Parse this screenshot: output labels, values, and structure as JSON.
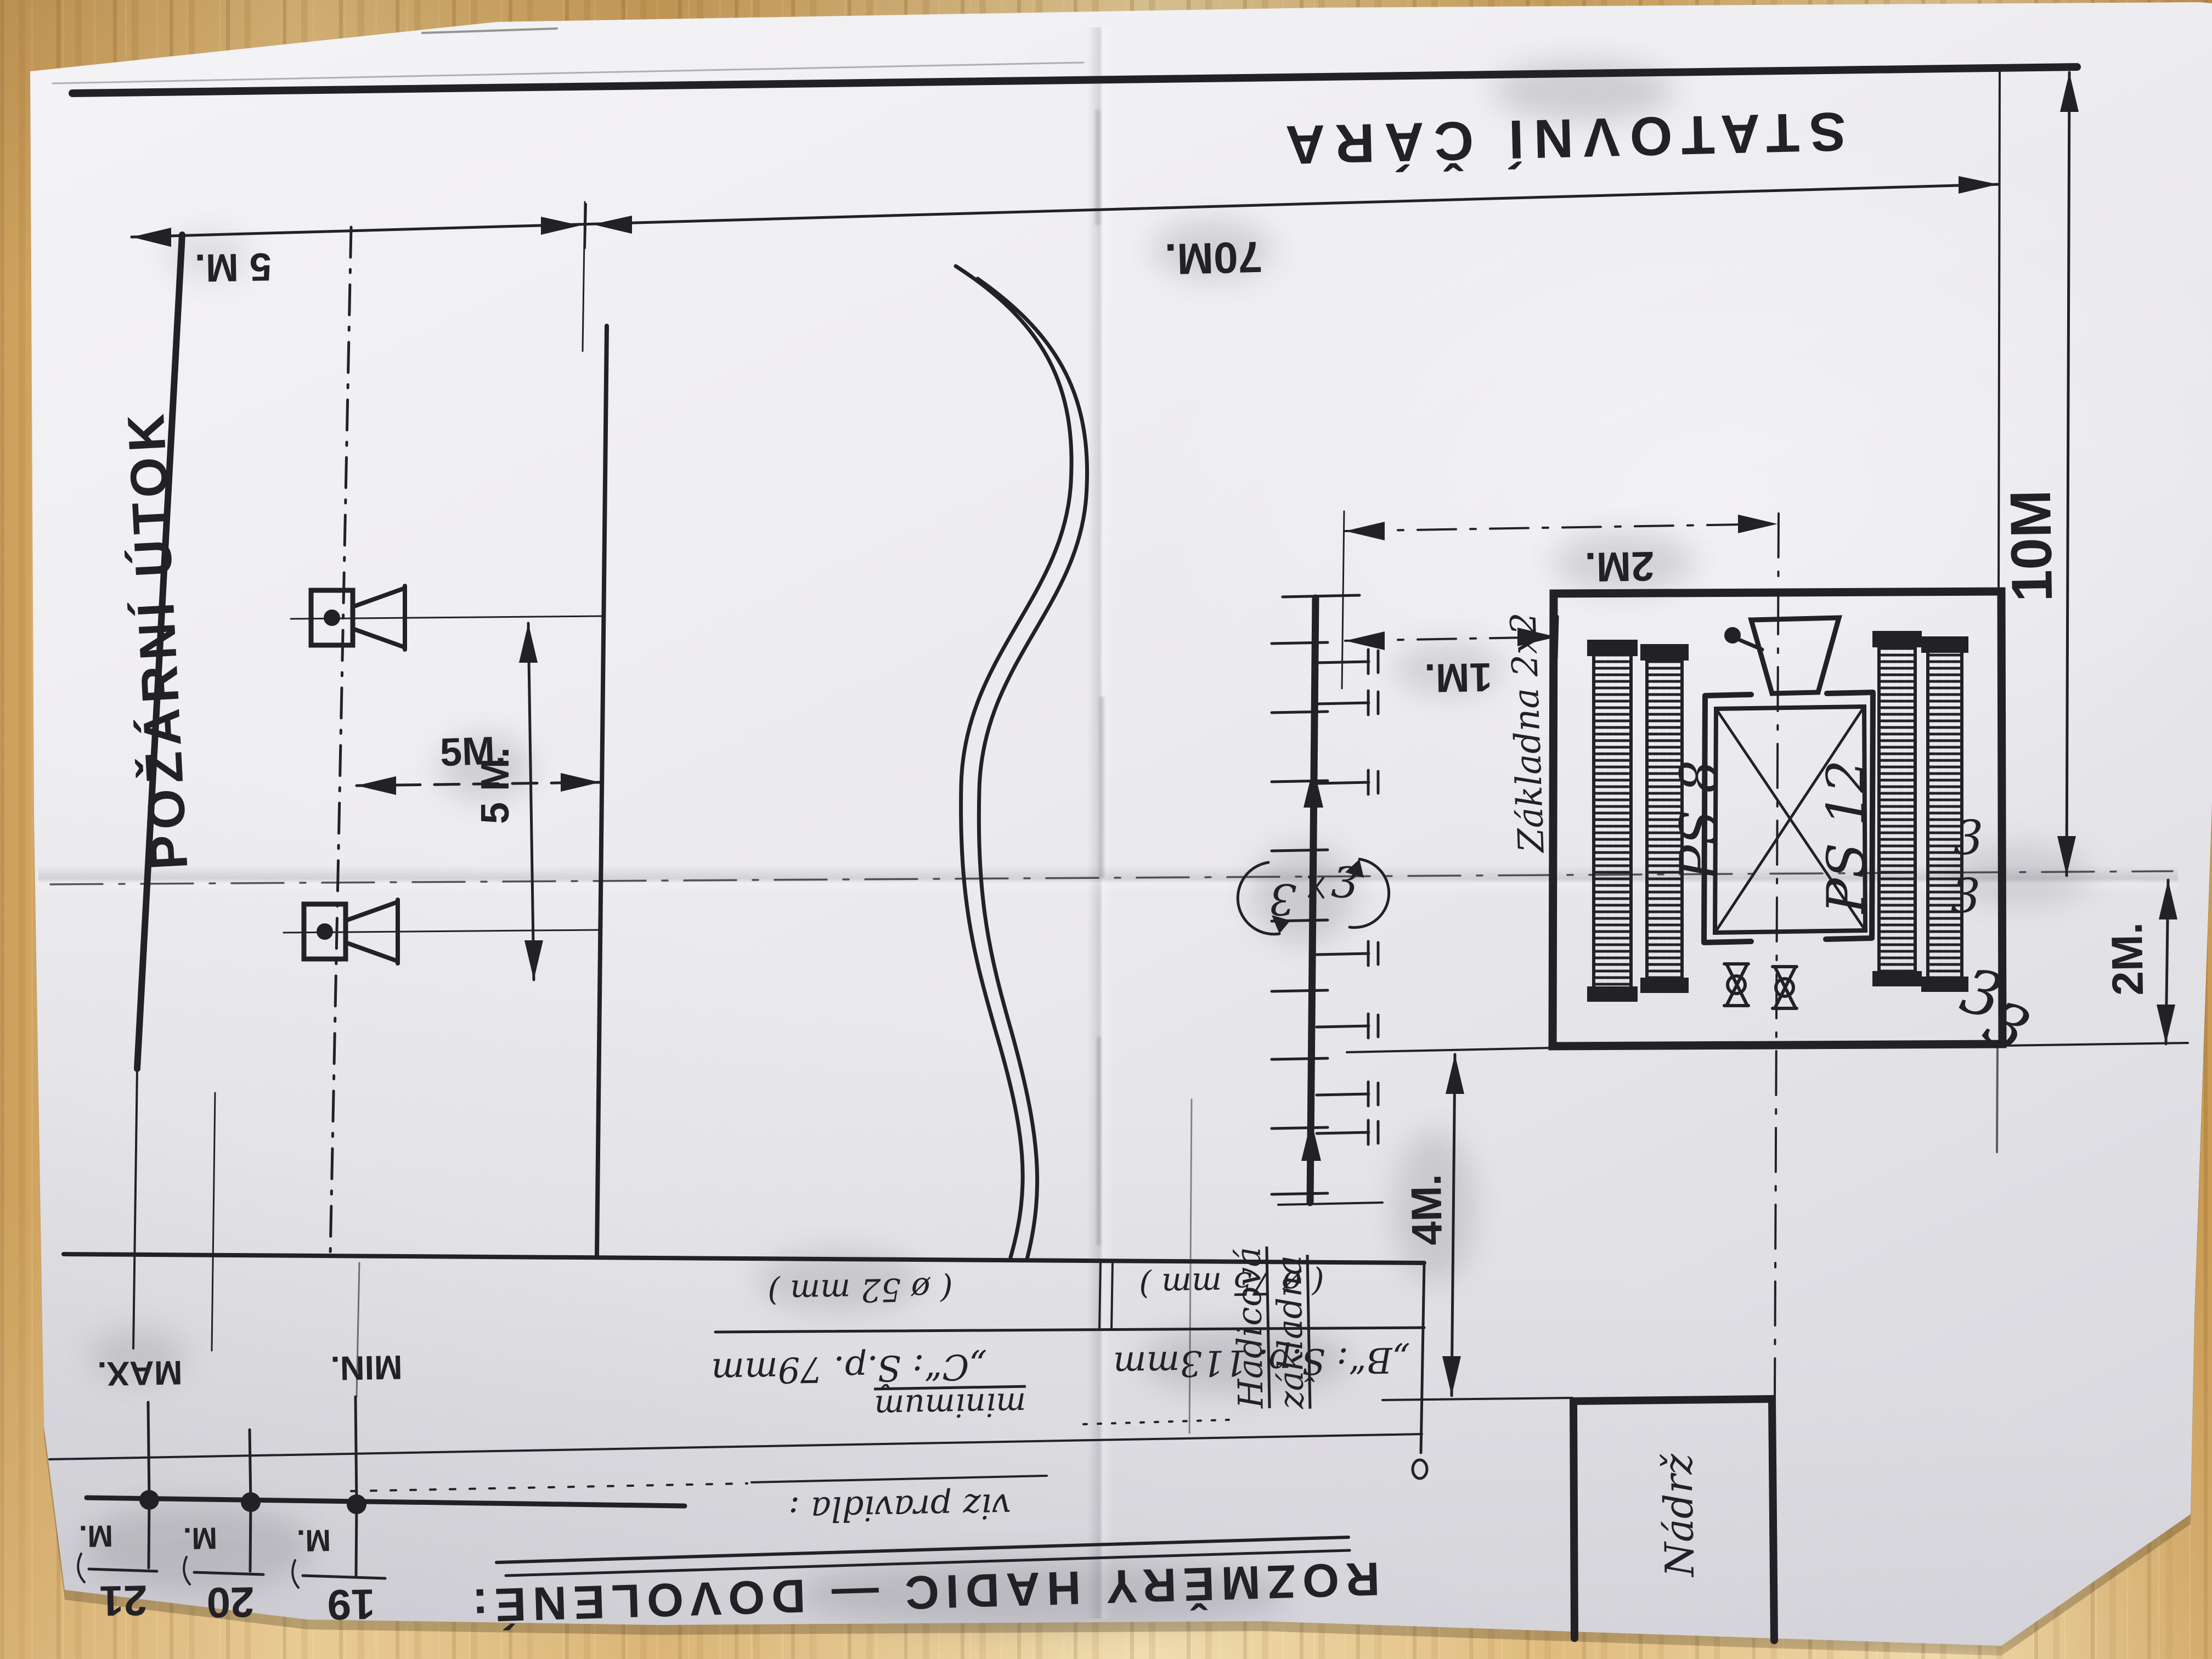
{
  "diagram": {
    "start_line": {
      "label": "STATOVNÍ ČÁRA"
    },
    "attack": {
      "label": "POŽÁRNÍ ÚTOK"
    },
    "dimensions": {
      "top_left": "5 M.",
      "top": "70M.",
      "right_height": "10M",
      "right_depth": "2M.",
      "targets_gap_h": "5M.",
      "targets_gap_v": "5 M.",
      "base_2m": "2M.",
      "base_1m": "1M.",
      "hose_to_tank": "4M."
    },
    "base": {
      "label": "Základna 2x2",
      "pump_left": "PS 8",
      "pump_right": "PS 12",
      "hook_symbol": "3"
    },
    "hose_base": {
      "label_line1": "Hadicová",
      "label_line2": "základna",
      "marker": "3"
    },
    "tank": {
      "label": "Nádrž"
    },
    "hose_table": {
      "heading": "ROZMĚRY HADIC — DOVOLENÉ:",
      "note": "viz pravidla :",
      "minimum": "minimum",
      "b_spec": "„B“: Š.p. 113mm",
      "c_spec": "„C“: Š.p. 79mm",
      "b_diameter": "( ø 75 mm )",
      "c_diameter": "( ø 52 mm )"
    },
    "length_marks": {
      "max": "MAX.",
      "min": "MIN.",
      "unit": "M.",
      "values": [
        "21",
        "20",
        "19"
      ]
    }
  }
}
